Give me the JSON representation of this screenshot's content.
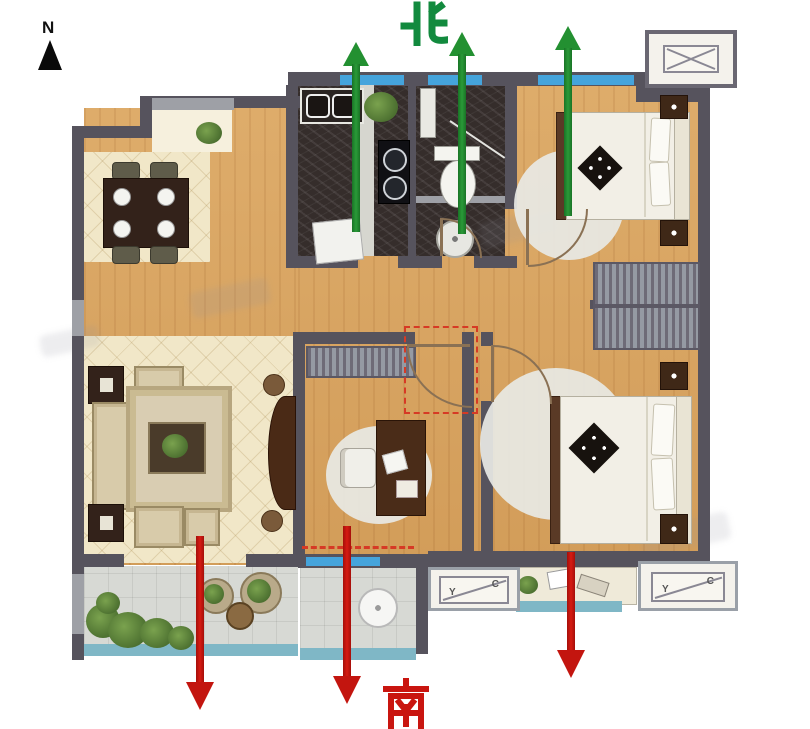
{
  "compass": {
    "label": "N"
  },
  "orientation": {
    "north_label": "北",
    "south_label": "南"
  },
  "ac_platforms": {
    "bottom_left": {
      "left_glyph": "Y",
      "right_glyph": "C"
    },
    "bottom_right": {
      "left_glyph": "Y",
      "right_glyph": "C"
    }
  },
  "colors": {
    "north_green": "#1f8c38",
    "south_red": "#c3150f",
    "wall": "#56535d",
    "window_blue": "#45a4dc",
    "rail_teal": "#7fb7c6",
    "wood": "#daa560",
    "tile_cream": "#f1e7c8",
    "kitchen_dark": "#352d2b",
    "balcony_gray": "#d7d9d4"
  }
}
